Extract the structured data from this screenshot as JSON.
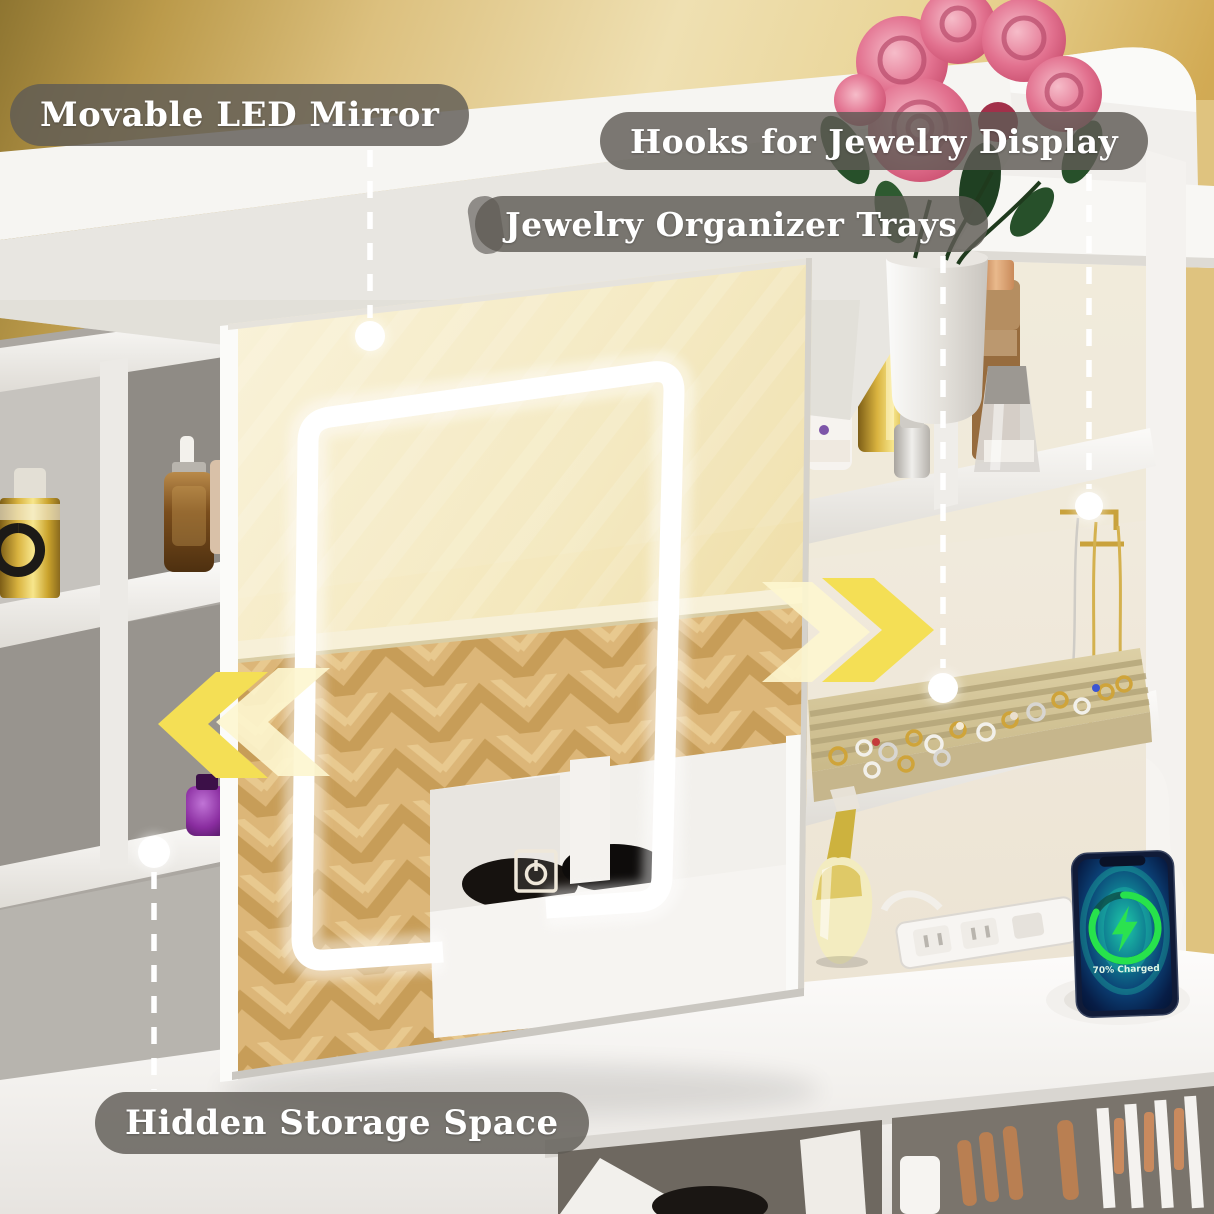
{
  "callouts": {
    "mirror": {
      "label": "Movable LED Mirror"
    },
    "hooks": {
      "label": "Hooks for Jewelry Display"
    },
    "trays": {
      "label": "Jewelry Organizer Trays"
    },
    "storage": {
      "label": "Hidden Storage Space"
    }
  },
  "phone": {
    "status": "70% Charged"
  },
  "colors": {
    "arrow_yellow": "#f4df55",
    "arrow_pale": "#fdf6cf",
    "label_bg": "rgba(95,92,86,0.82)",
    "wall_gold": "#cfa952",
    "led_white": "#ffffff",
    "charge_green": "#2be24f",
    "tray_beige": "#d9cba2"
  },
  "icons": {
    "power": "touch-power-icon",
    "arrow_left": "slide-left-arrow-icon",
    "arrow_right": "slide-right-arrow-icon",
    "bolt": "charging-bolt-icon",
    "dot": "callout-dot"
  }
}
